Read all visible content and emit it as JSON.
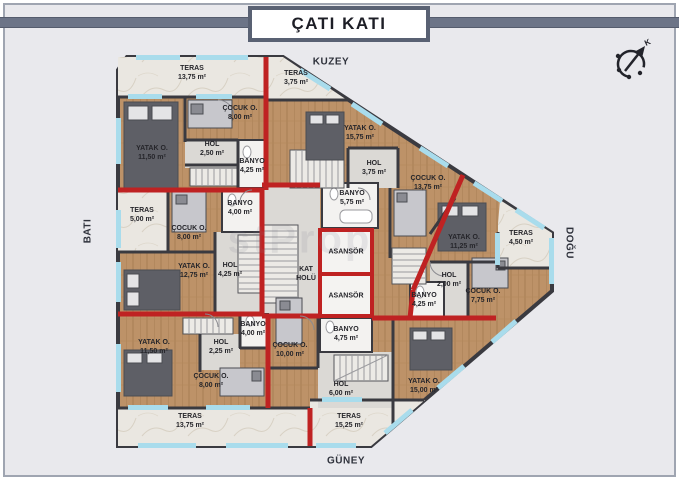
{
  "title": "ÇATI KATI",
  "cardinal": {
    "north": "KUZEY",
    "south": "GÜNEY",
    "west": "BATI",
    "east": "DOĞU"
  },
  "compass": {
    "north_letter": "K"
  },
  "watermark": "stProp",
  "colors": {
    "background": "#e9e9ed",
    "dark_wall": "#3a3a40",
    "red_wall": "#bf2222",
    "window": "#a9dcec",
    "wood_floor": "#bd9268",
    "marble_floor": "#eae7e1",
    "slate_accent": "#596173"
  },
  "rooms": [
    {
      "id": "teras-nw",
      "lines": [
        "TERAS",
        "13,75 m²"
      ],
      "x": 192,
      "y": 73
    },
    {
      "id": "cocuk-nw",
      "lines": [
        "ÇOCUK O.",
        "8,00 m²"
      ],
      "x": 240,
      "y": 113
    },
    {
      "id": "yatak-nw",
      "lines": [
        "YATAK O.",
        "11,50 m²"
      ],
      "x": 152,
      "y": 153
    },
    {
      "id": "hol-nw",
      "lines": [
        "HOL",
        "2,50 m²"
      ],
      "x": 212,
      "y": 149
    },
    {
      "id": "banyo-nw",
      "lines": [
        "BANYO",
        "4,25 m²"
      ],
      "x": 252,
      "y": 166
    },
    {
      "id": "teras-n",
      "lines": [
        "TERAS",
        "3,75 m²"
      ],
      "x": 296,
      "y": 78
    },
    {
      "id": "yatak-n",
      "lines": [
        "YATAK O.",
        "15,75 m²"
      ],
      "x": 360,
      "y": 133
    },
    {
      "id": "hol-n",
      "lines": [
        "HOL",
        "3,75 m²"
      ],
      "x": 374,
      "y": 168
    },
    {
      "id": "banyo-n",
      "lines": [
        "BANYO",
        "5,75 m²"
      ],
      "x": 352,
      "y": 198
    },
    {
      "id": "teras-w",
      "lines": [
        "TERAS",
        "5,00 m²"
      ],
      "x": 142,
      "y": 215
    },
    {
      "id": "banyo-w",
      "lines": [
        "BANYO",
        "4,00 m²"
      ],
      "x": 240,
      "y": 208
    },
    {
      "id": "cocuk-w",
      "lines": [
        "ÇOCUK O.",
        "8,00 m²"
      ],
      "x": 189,
      "y": 233
    },
    {
      "id": "yatak-w",
      "lines": [
        "YATAK O.",
        "12,75 m²"
      ],
      "x": 194,
      "y": 271
    },
    {
      "id": "hol-w",
      "lines": [
        "HOL",
        "4,25 m²"
      ],
      "x": 230,
      "y": 270
    },
    {
      "id": "kat-holu",
      "lines": [
        "KAT",
        "HOLÜ"
      ],
      "x": 306,
      "y": 274
    },
    {
      "id": "asansor-1",
      "lines": [
        "ASANSÖR"
      ],
      "x": 346,
      "y": 252
    },
    {
      "id": "asansor-2",
      "lines": [
        "ASANSÖR"
      ],
      "x": 346,
      "y": 296
    },
    {
      "id": "cocuk-e",
      "lines": [
        "ÇOCUK O.",
        "13,75 m²"
      ],
      "x": 428,
      "y": 183
    },
    {
      "id": "yatak-e",
      "lines": [
        "YATAK O.",
        "11,25 m²"
      ],
      "x": 464,
      "y": 242
    },
    {
      "id": "teras-e",
      "lines": [
        "TERAS",
        "4,50 m²"
      ],
      "x": 521,
      "y": 238
    },
    {
      "id": "hol-e",
      "lines": [
        "HOL",
        "2,00 m²"
      ],
      "x": 449,
      "y": 280
    },
    {
      "id": "banyo-e",
      "lines": [
        "BANYO",
        "4,25 m²"
      ],
      "x": 424,
      "y": 300
    },
    {
      "id": "cocuk-e2",
      "lines": [
        "ÇOCUK O.",
        "7,75 m²"
      ],
      "x": 483,
      "y": 296
    },
    {
      "id": "yatak-se",
      "lines": [
        "YATAK O.",
        "15,00 m²"
      ],
      "x": 424,
      "y": 386
    },
    {
      "id": "yatak-sw",
      "lines": [
        "YATAK O.",
        "11,50 m²"
      ],
      "x": 154,
      "y": 347
    },
    {
      "id": "hol-sw",
      "lines": [
        "HOL",
        "2,25 m²"
      ],
      "x": 221,
      "y": 347
    },
    {
      "id": "banyo-sw",
      "lines": [
        "BANYO",
        "4,00 m²"
      ],
      "x": 253,
      "y": 329
    },
    {
      "id": "cocuk-sw",
      "lines": [
        "ÇOCUK O.",
        "8,00 m²"
      ],
      "x": 211,
      "y": 381
    },
    {
      "id": "teras-sw",
      "lines": [
        "TERAS",
        "13,75 m²"
      ],
      "x": 190,
      "y": 421
    },
    {
      "id": "banyo-s",
      "lines": [
        "BANYO",
        "4,75 m²"
      ],
      "x": 346,
      "y": 334
    },
    {
      "id": "cocuk-s",
      "lines": [
        "ÇOCUK O.",
        "10,00 m²"
      ],
      "x": 290,
      "y": 350
    },
    {
      "id": "hol-s",
      "lines": [
        "HOL",
        "6,00 m²"
      ],
      "x": 341,
      "y": 389
    },
    {
      "id": "teras-s",
      "lines": [
        "TERAS",
        "15,25 m²"
      ],
      "x": 349,
      "y": 421
    }
  ]
}
